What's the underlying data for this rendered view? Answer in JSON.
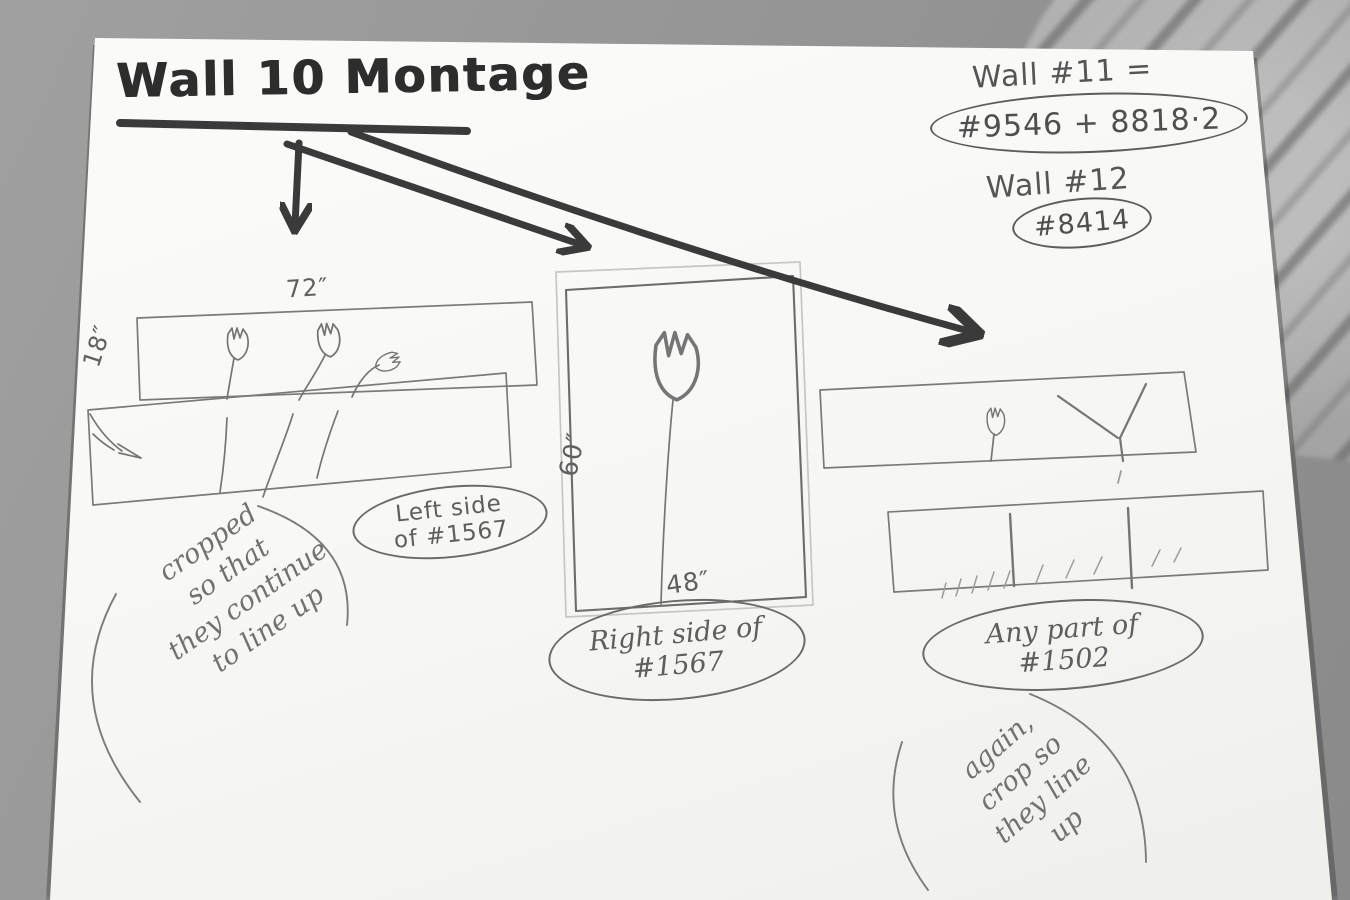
{
  "colors": {
    "backdrop": "#959595",
    "marble": "#b6b6b6",
    "paper": "#f8f8f6",
    "marker_ink": "#3a3a3a",
    "pencil": "#6e6e6e"
  },
  "title": {
    "text": "Wall 10 Montage"
  },
  "wall_refs": {
    "wall11_label": "Wall #11 =",
    "wall11_numbers": "#9546 + 8818·2",
    "wall12_label": "Wall #12",
    "wall12_numbers": "#8414"
  },
  "left_montage": {
    "width_label": "72″",
    "height_label": "18″",
    "caption": {
      "line1": "Left side",
      "line2": "of #1567"
    },
    "note": {
      "line1": "cropped",
      "line2": "so that",
      "line3": "they continue",
      "line4": "to line up"
    }
  },
  "center_montage": {
    "height_label": "60″",
    "width_label": "48″",
    "caption": {
      "line1": "Right side of",
      "line2": "#1567"
    }
  },
  "right_montage": {
    "caption": {
      "line1": "Any part of",
      "line2": "#1502"
    },
    "note": {
      "line1": "again,",
      "line2": "crop so",
      "line3": "they line",
      "line4": "up"
    }
  }
}
